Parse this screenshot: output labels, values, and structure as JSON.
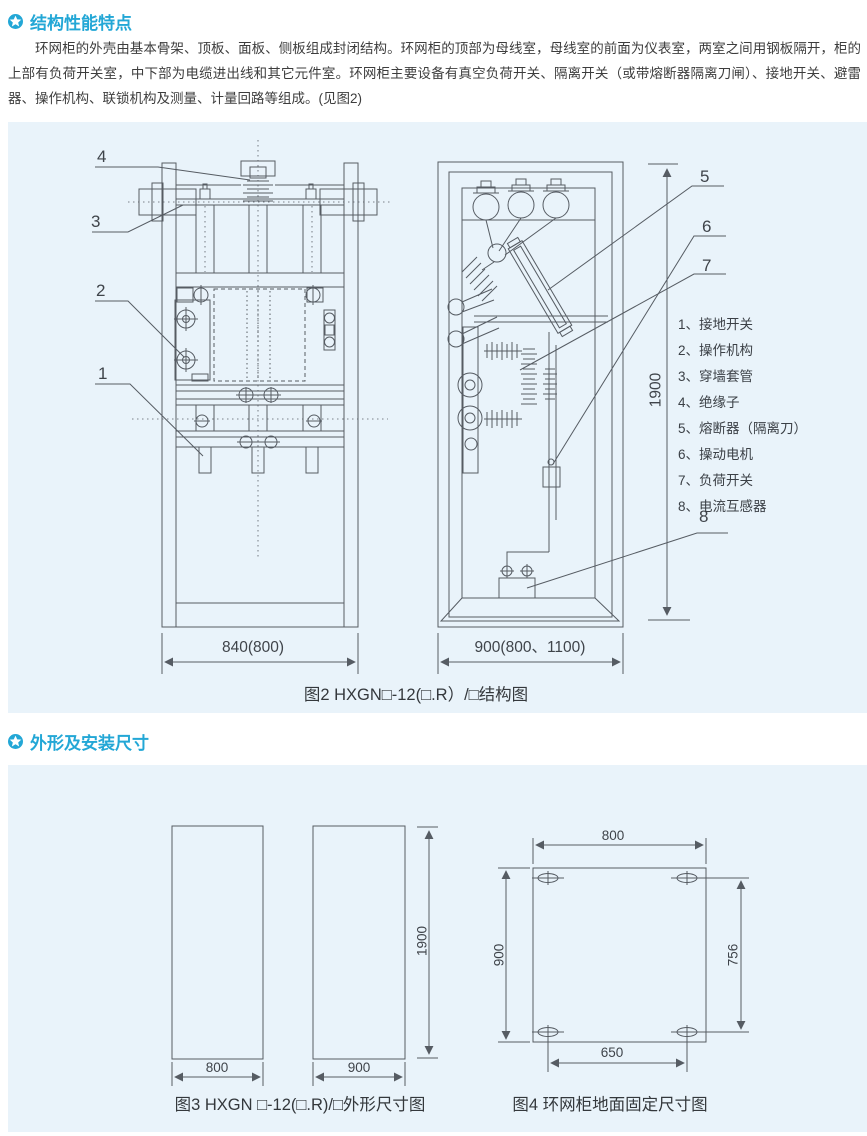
{
  "page": {
    "accent_color": "#23a7d6",
    "panel_bg_color": "#e9f3fa",
    "line_color": "#565c63",
    "text_color": "#3d3d3d"
  },
  "section1": {
    "title": "结构性能特点",
    "paragraph": "环网柜的外壳由基本骨架、顶板、面板、侧板组成封闭结构。环网柜的顶部为母线室，母线室的前面为仪表室，两室之间用钢板隔开，柜的上部有负荷开关室，中下部为电缆进出线和其它元件室。环网柜主要设备有真空负荷开关、隔离开关（或带熔断器隔离刀闸）、接地开关、避雷器、操作机构、联锁机构及测量、计量回路等组成。(见图2)"
  },
  "figure2": {
    "caption": "图2 HXGN□-12(□.R）/□结构图",
    "callouts": [
      "1",
      "2",
      "3",
      "4",
      "5",
      "6",
      "7",
      "8"
    ],
    "legend": [
      "1、接地开关",
      "2、操作机构",
      "3、穿墙套管",
      "4、绝缘子",
      "5、熔断器（隔离刀）",
      "6、操动电机",
      "7、负荷开关",
      "8、电流互感器"
    ],
    "dims": {
      "front_width": "840(800)",
      "side_width": "900(800、1100)",
      "height": "1900"
    }
  },
  "section2": {
    "title": "外形及安装尺寸"
  },
  "figure3": {
    "caption": "图3 HXGN □-12(□.R)/□外形尺寸图",
    "dims": {
      "front_width": "800",
      "side_width": "900",
      "height": "1900"
    }
  },
  "figure4": {
    "caption": "图4 环网柜地面固定尺寸图",
    "dims": {
      "top": "800",
      "left": "900",
      "right": "756",
      "bottom": "650"
    }
  }
}
